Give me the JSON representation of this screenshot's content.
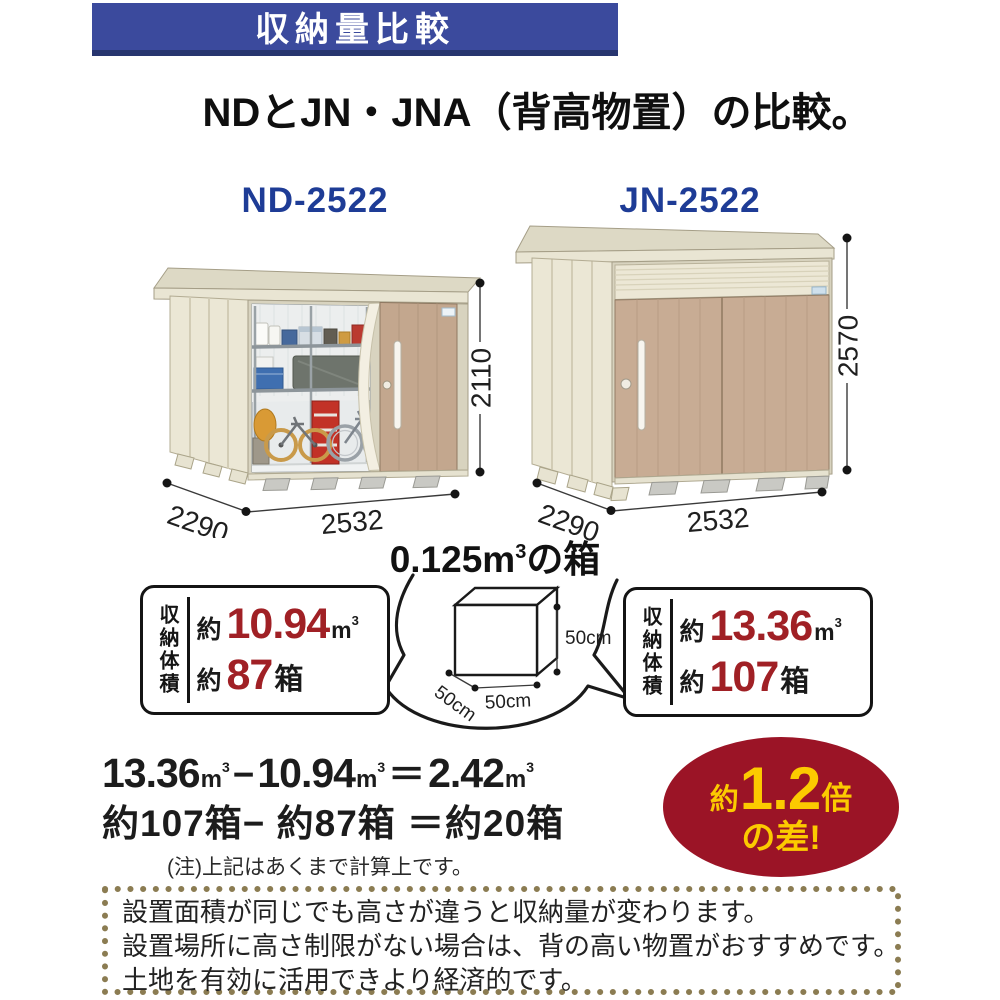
{
  "banner": {
    "title": "収納量比較"
  },
  "subtitle": "NDとJN・JNA（背高物置）の比較。",
  "sheds": {
    "left": {
      "model": "ND-2522",
      "width": "2532",
      "depth": "2290",
      "height": "2110"
    },
    "right": {
      "model": "JN-2522",
      "width": "2532",
      "depth": "2290",
      "height": "2570"
    }
  },
  "cube": {
    "title_num": "0.125m",
    "title_sup": "3",
    "title_tail": "の箱",
    "dim_height": "50cm",
    "dim_width": "50cm",
    "dim_depth": "50cm"
  },
  "volume": {
    "left": {
      "side_label": "収納体積",
      "approx1": "約",
      "value": "10.94",
      "unit": "m",
      "unit_sup": "3",
      "approx2": "約",
      "count": "87",
      "count_unit": "箱"
    },
    "right": {
      "side_label": "収納体積",
      "approx1": "約",
      "value": "13.36",
      "unit": "m",
      "unit_sup": "3",
      "approx2": "約",
      "count": "107",
      "count_unit": "箱"
    }
  },
  "calc": {
    "n1": "13.36",
    "minus": "−",
    "n2": "10.94",
    "equals": "＝",
    "n3": "2.42",
    "unit": "m",
    "unit_sup": "3",
    "line2": "約107箱− 約87箱 ＝約20箱",
    "note": "(注)上記はあくまで計算上です。"
  },
  "badge": {
    "approx": "約",
    "value": "1.2",
    "times": "倍",
    "line2": "の差!"
  },
  "footer": {
    "lines": [
      "設置面積が同じでも高さが違うと収納量が変わります。",
      "設置場所に高さ制限がない場合は、背の高い物置がおすすめです。",
      "土地を有効に活用できより経済的です。"
    ]
  },
  "colors": {
    "banner_bg": "#3b4a9d",
    "banner_edge": "#27356f",
    "model_label_blue": "#1e3c96",
    "value_red": "#a02025",
    "badge_bg": "#9b1426",
    "badge_text": "#fcca00",
    "shed_wall_cream": "#ebe7d5",
    "shed_door_tan": "#c3a78e",
    "footer_dot_border": "#8b7c52"
  }
}
